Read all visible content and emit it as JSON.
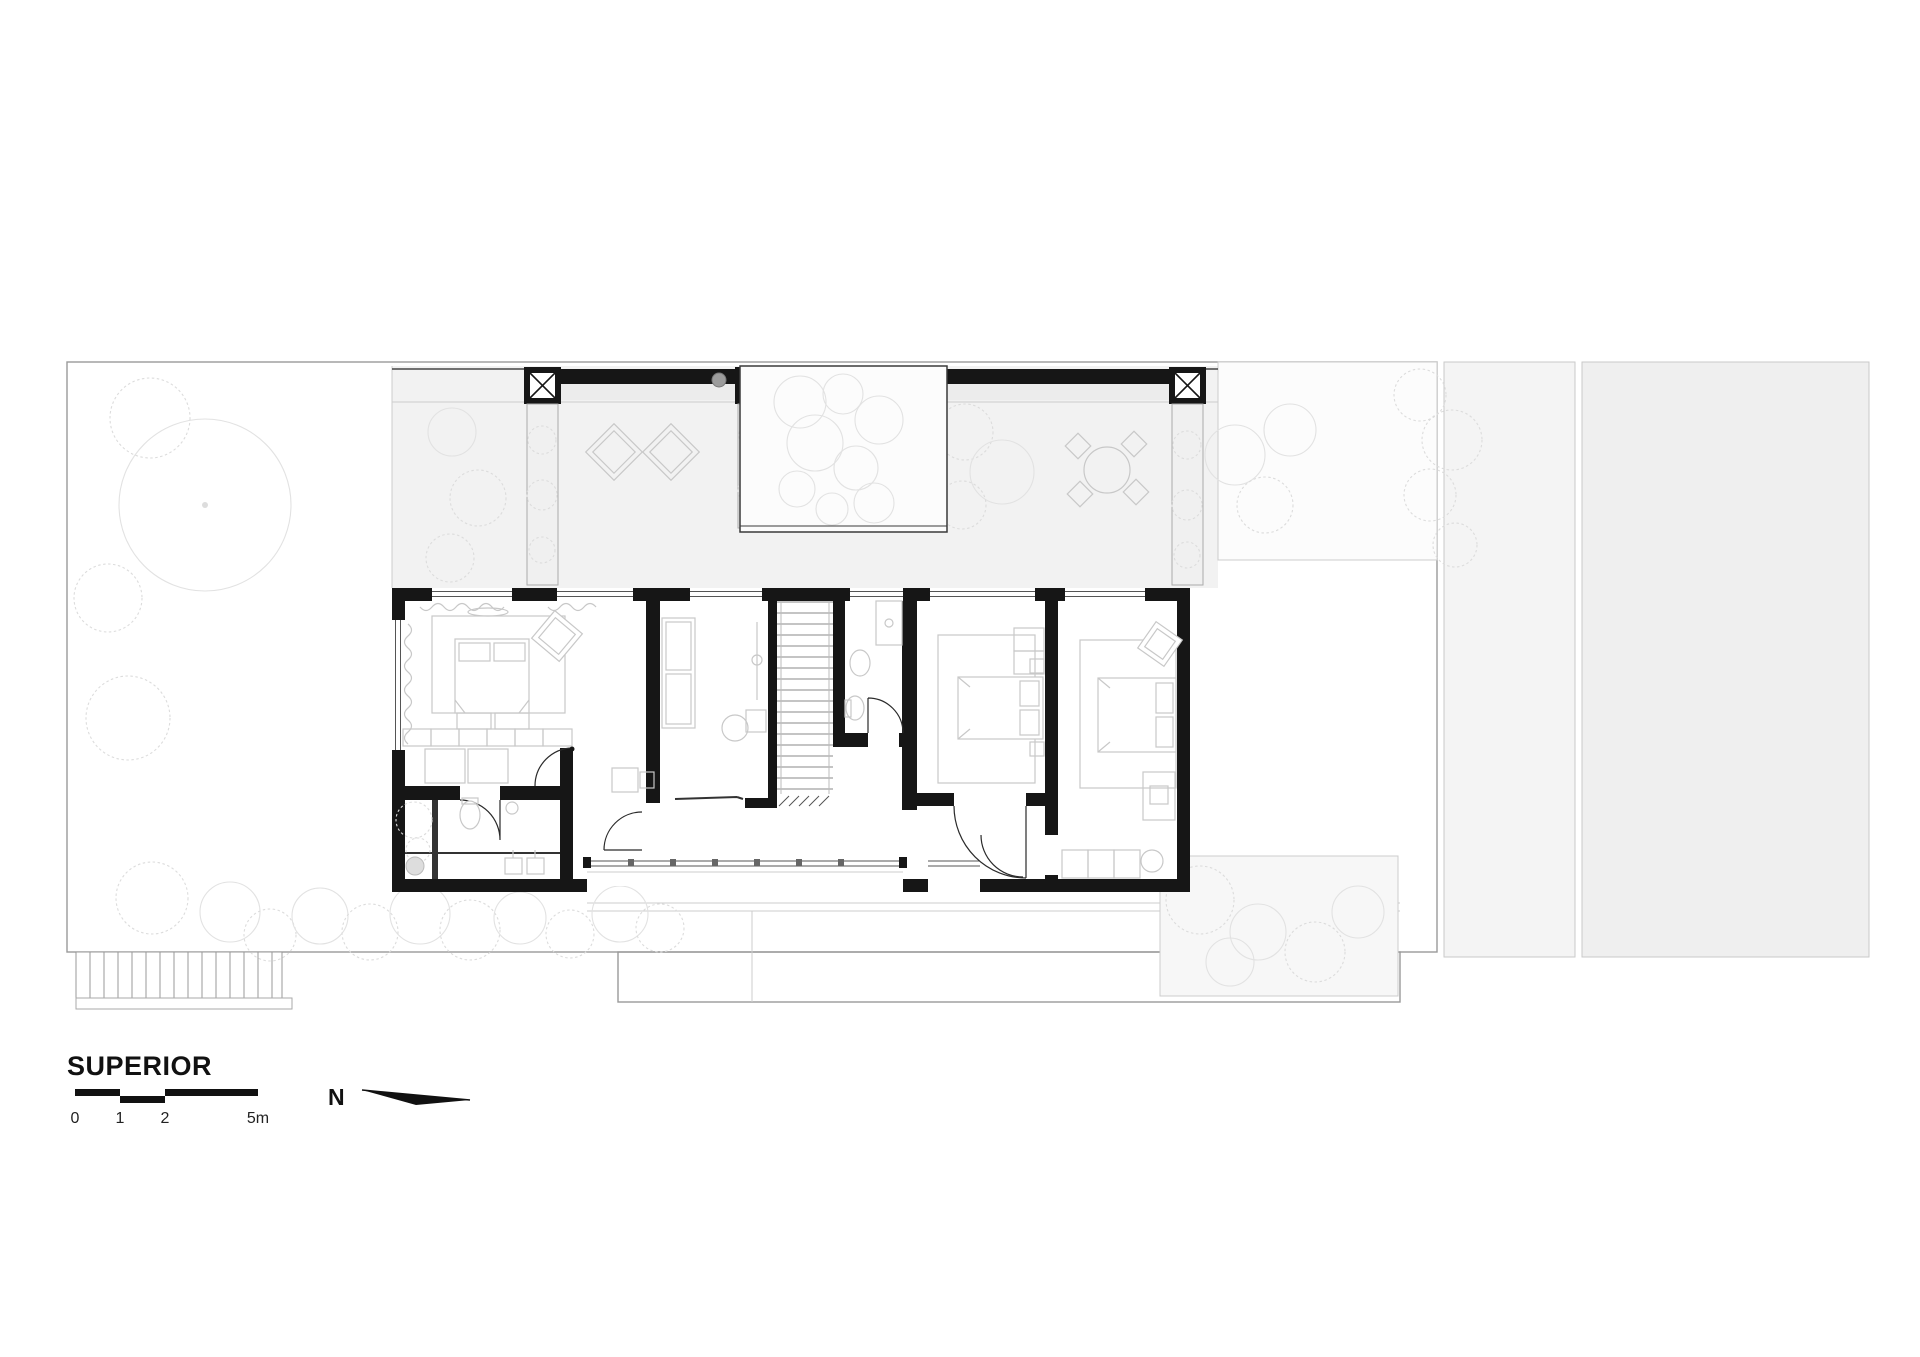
{
  "title_block": {
    "floor_label": "SUPERIOR"
  },
  "scale_bar": {
    "ticks": [
      "0",
      "1",
      "2",
      "5m"
    ]
  },
  "compass": {
    "label": "N"
  },
  "colors": {
    "wall": "#161616",
    "site_fill": "#f8f8f8",
    "terrace_fill": "#f2f2f2",
    "void_fill": "#fcfcfc",
    "neighbor_a_fill": "#f4f4f4",
    "neighbor_b_fill": "#efefef",
    "furniture_stroke": "#c8c8c8",
    "vegetation_stroke": "#e0e0e0"
  }
}
